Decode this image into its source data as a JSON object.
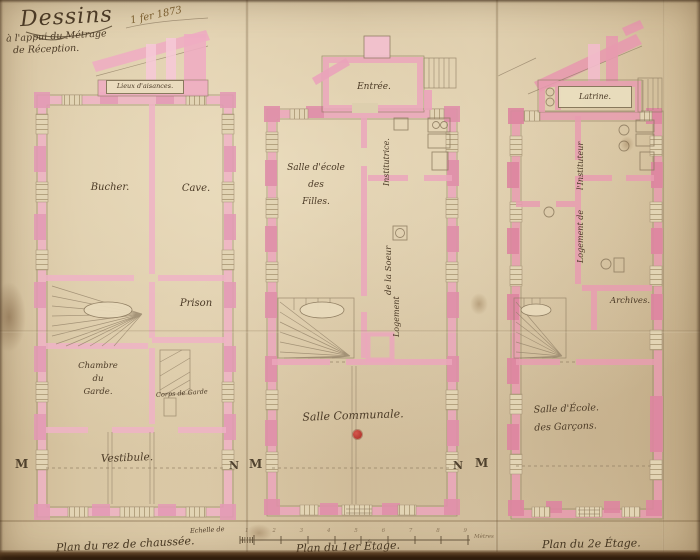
{
  "colors": {
    "paper": "#d7c5a2",
    "wall_pink": "#ecaec2",
    "wall_pink_dark": "#df8fa9",
    "ink": "#5f5038",
    "red_dot": "#c0392b"
  },
  "title_block": {
    "title": "Dessins",
    "subtitle_line1": "à l'appui du Métrage",
    "subtitle_line2": "de Réception.",
    "date_note": "1 fer 1873"
  },
  "ground_floor": {
    "caption": "Plan du rez de chaussée.",
    "annex_label": "Lieux d'aisances.",
    "rooms": {
      "bucher": "Bucher.",
      "cave": "Cave.",
      "prison": "Prison",
      "chambre_garde": "Chambre\ndu\nGarde.",
      "corps_de_garde": "Corps de Garde",
      "vestibule": "Vestibule."
    },
    "scale_note": "Echelle de",
    "marker_left": "M",
    "marker_right": "N"
  },
  "first_floor": {
    "caption": "Plan du 1er Étage.",
    "rooms": {
      "entree": "Entrée.",
      "salle_ecole_filles": "Salle d'école\ndes\nFilles.",
      "logement_vertical_1": "Logement",
      "logement_vertical_2": "de la Soeur",
      "logement_vertical_3": "Institutrice.",
      "salle_communale": "Salle Communale."
    },
    "marker_left": "M",
    "marker_right": "N"
  },
  "second_floor": {
    "caption": "Plan du 2e Étage.",
    "rooms": {
      "latrine": "Latrine.",
      "logement_vertical_1": "Logement de",
      "logement_vertical_2": "l'Instituteur",
      "archives": "Archives.",
      "salle_ecole_garcons": "Salle d'École.\ndes Garçons."
    },
    "marker_left": "M"
  },
  "scale_bar": {
    "numbers": [
      "1",
      "2",
      "3",
      "4",
      "5",
      "6",
      "7",
      "8",
      "9"
    ],
    "end_label": "Mètres"
  }
}
